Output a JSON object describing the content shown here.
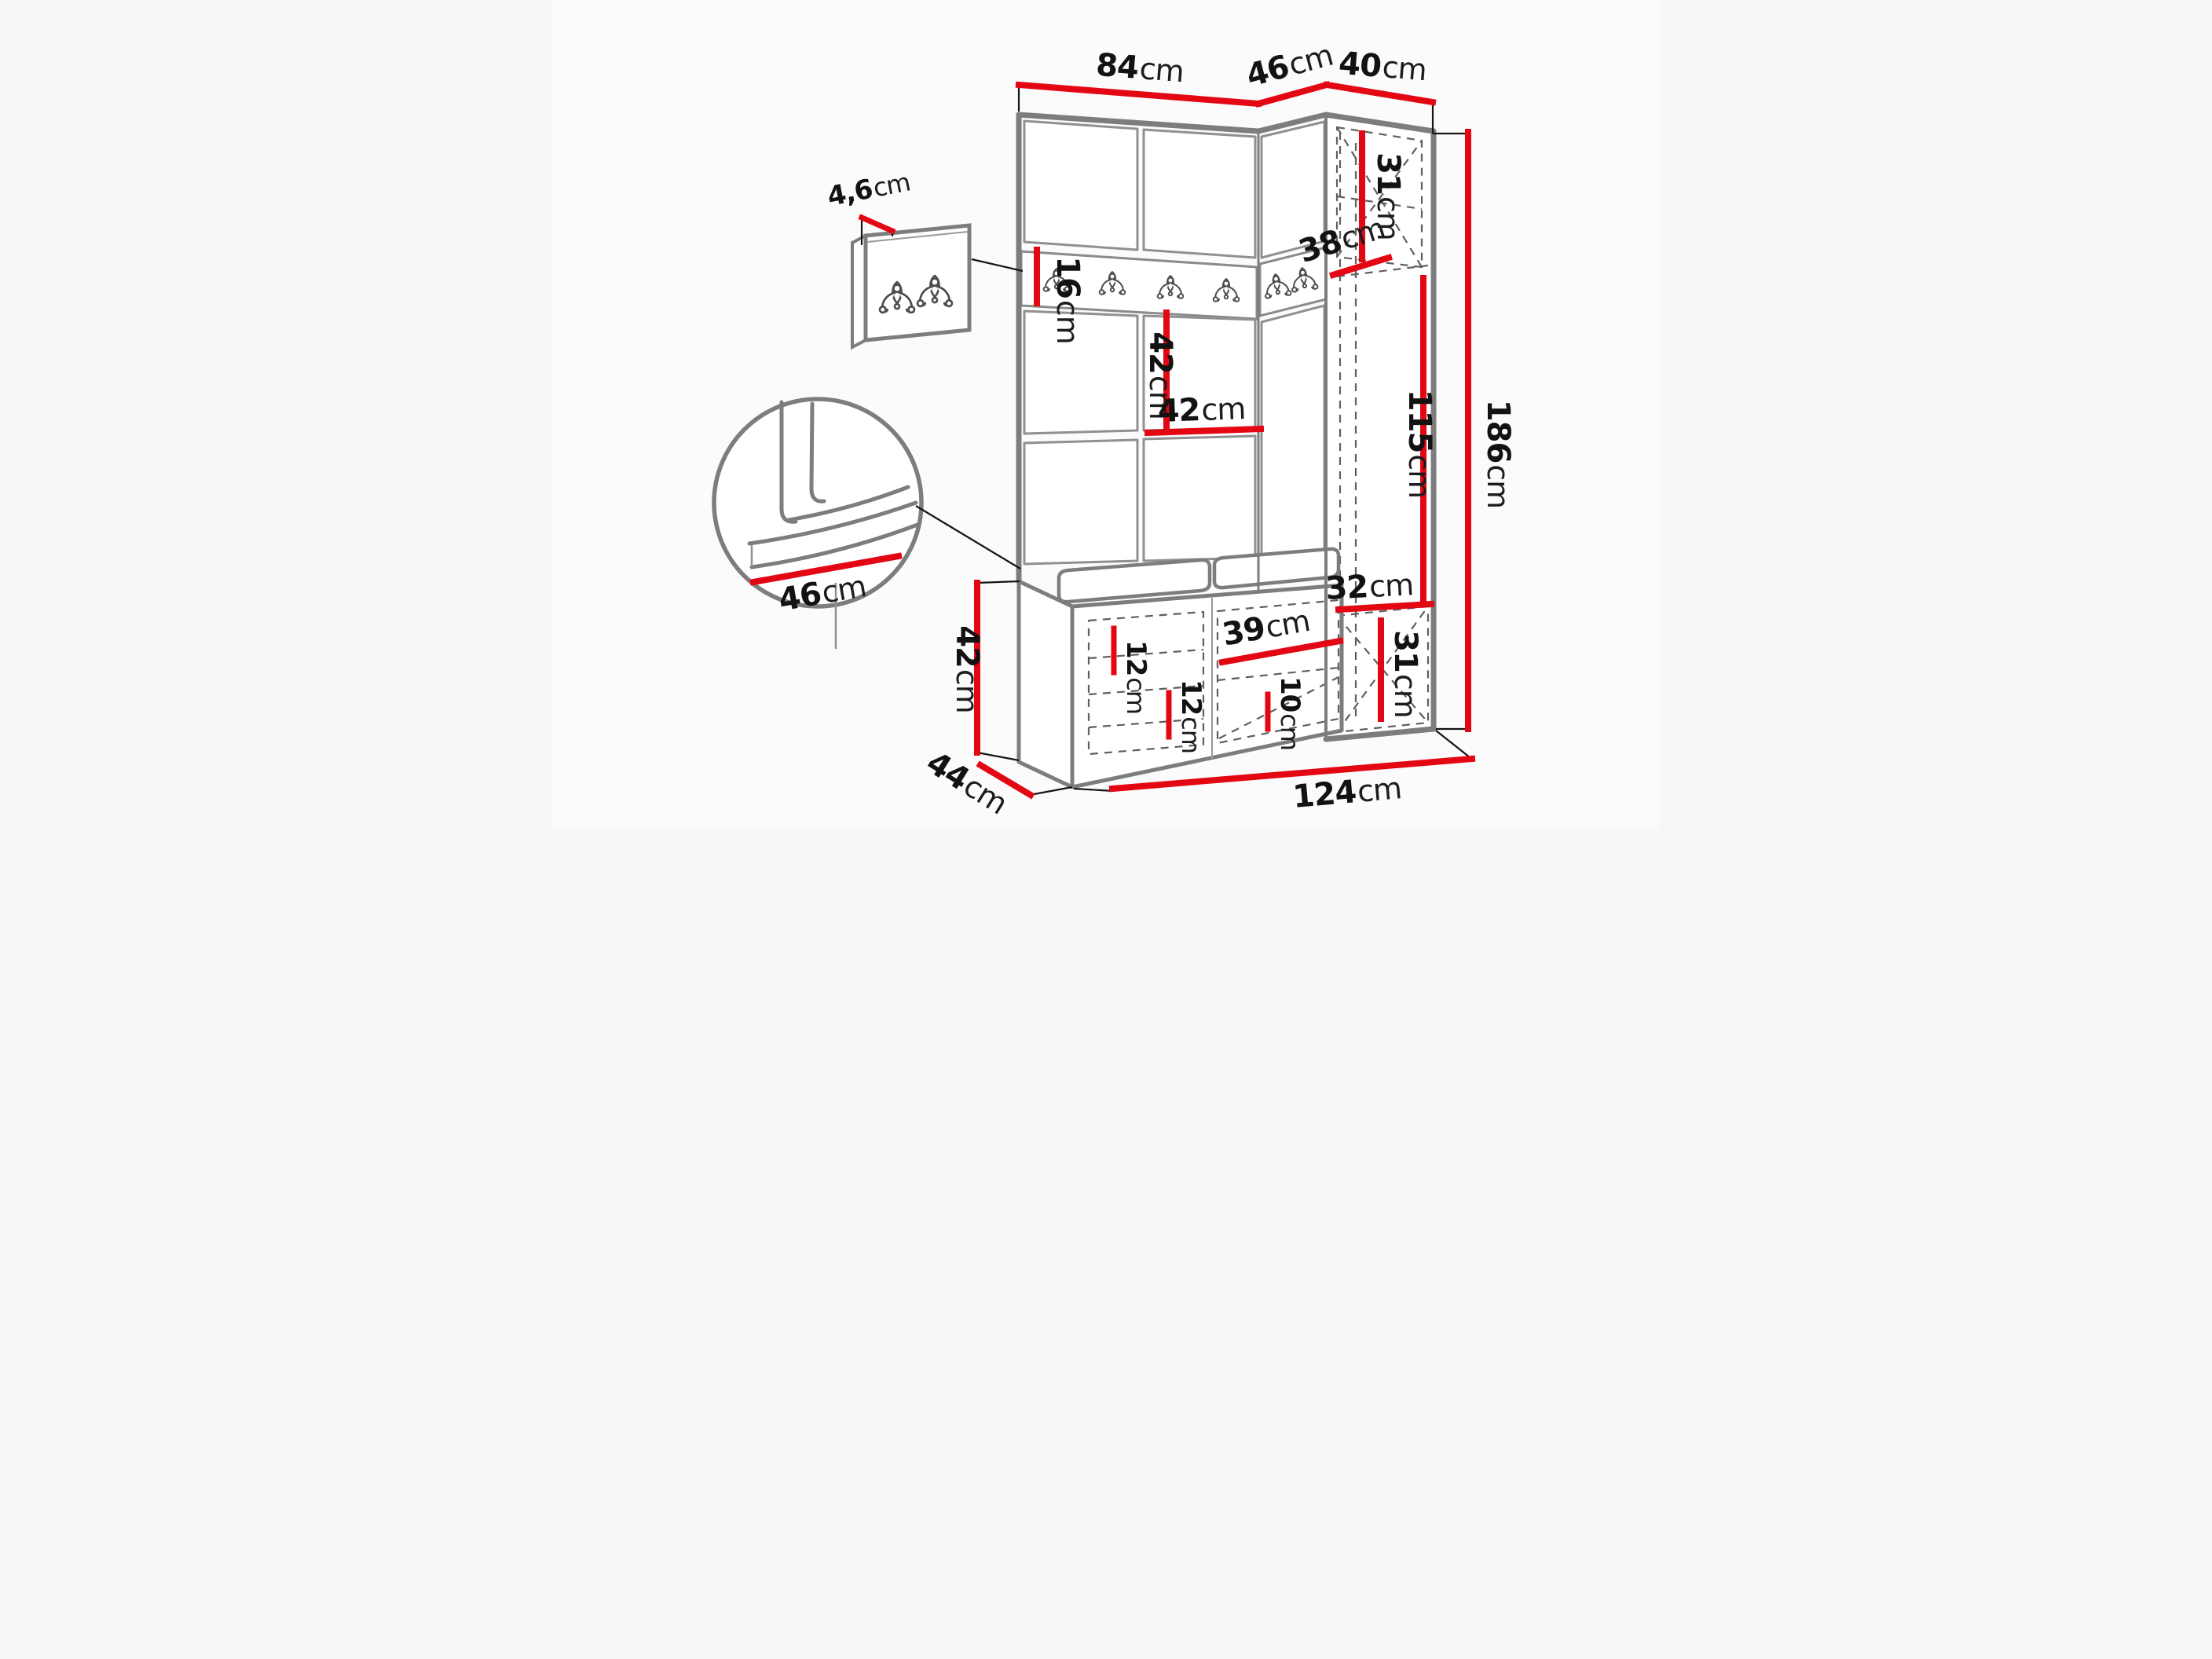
{
  "colors": {
    "dimension_red": "#e30613",
    "outline_gray": "#7d7d7d",
    "panel_gray": "#8f8f8f",
    "dash_gray": "#5f5f5f",
    "line_black": "#141414",
    "background": "#fbfbfb"
  },
  "hook_rail": {
    "hook_count": 6
  },
  "wall_panel_detail": {
    "hook_count": 2
  },
  "labels": {
    "top_width_left": {
      "value": "84",
      "unit": "cm"
    },
    "top_width_corner": {
      "value": "46",
      "unit": "cm"
    },
    "top_width_right": {
      "value": "40",
      "unit": "cm"
    },
    "panel_thickness": {
      "value": "4,6",
      "unit": "cm"
    },
    "rail_height": {
      "value": "16",
      "unit": "cm"
    },
    "cabinet_top_height": {
      "value": "31",
      "unit": "cm"
    },
    "cabinet_depth": {
      "value": "38",
      "unit": "cm"
    },
    "panel_row_height": {
      "value": "42",
      "unit": "cm"
    },
    "panel_column_width": {
      "value": "42",
      "unit": "cm"
    },
    "niche_height": {
      "value": "115",
      "unit": "cm"
    },
    "total_height": {
      "value": "186",
      "unit": "cm"
    },
    "seat_depth_detail": {
      "value": "46",
      "unit": "cm"
    },
    "bench_height": {
      "value": "42",
      "unit": "cm"
    },
    "bench_depth": {
      "value": "44",
      "unit": "cm"
    },
    "shelf_gap_upper": {
      "value": "12",
      "unit": "cm"
    },
    "shelf_gap_lower": {
      "value": "12",
      "unit": "cm"
    },
    "middle_compartment_width": {
      "value": "39",
      "unit": "cm"
    },
    "middle_shelf_gap": {
      "value": "10",
      "unit": "cm"
    },
    "bottom_shelf_width": {
      "value": "32",
      "unit": "cm"
    },
    "cabinet_bottom_height": {
      "value": "31",
      "unit": "cm"
    },
    "total_width": {
      "value": "124",
      "unit": "cm"
    }
  }
}
